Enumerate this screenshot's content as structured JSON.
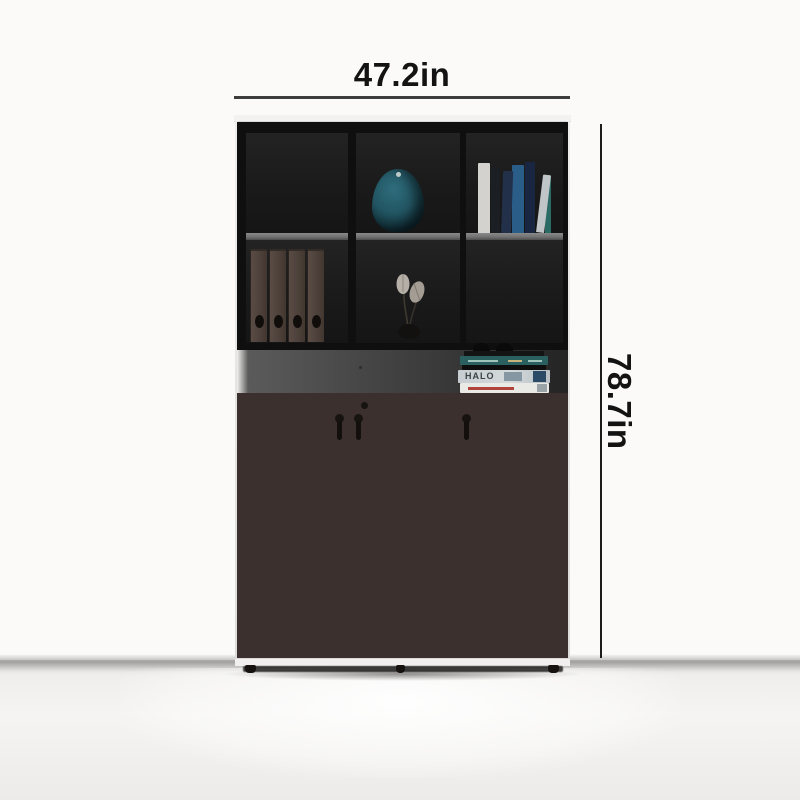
{
  "annotations": {
    "width_label": "47.2in",
    "height_label": "78.7in"
  },
  "decor": {
    "halo_book_text": "HALO"
  },
  "colors": {
    "wall": "#fbfaf8",
    "dimension_text": "#131313",
    "door": "#7a6663",
    "door_top": "#8b7672",
    "cabinet_body": "#0f0f0f",
    "shelf_edge": "#6f6f6f",
    "open_back": "#454545",
    "vase_teal": "#225663",
    "base_white": "#f2f0ee"
  }
}
